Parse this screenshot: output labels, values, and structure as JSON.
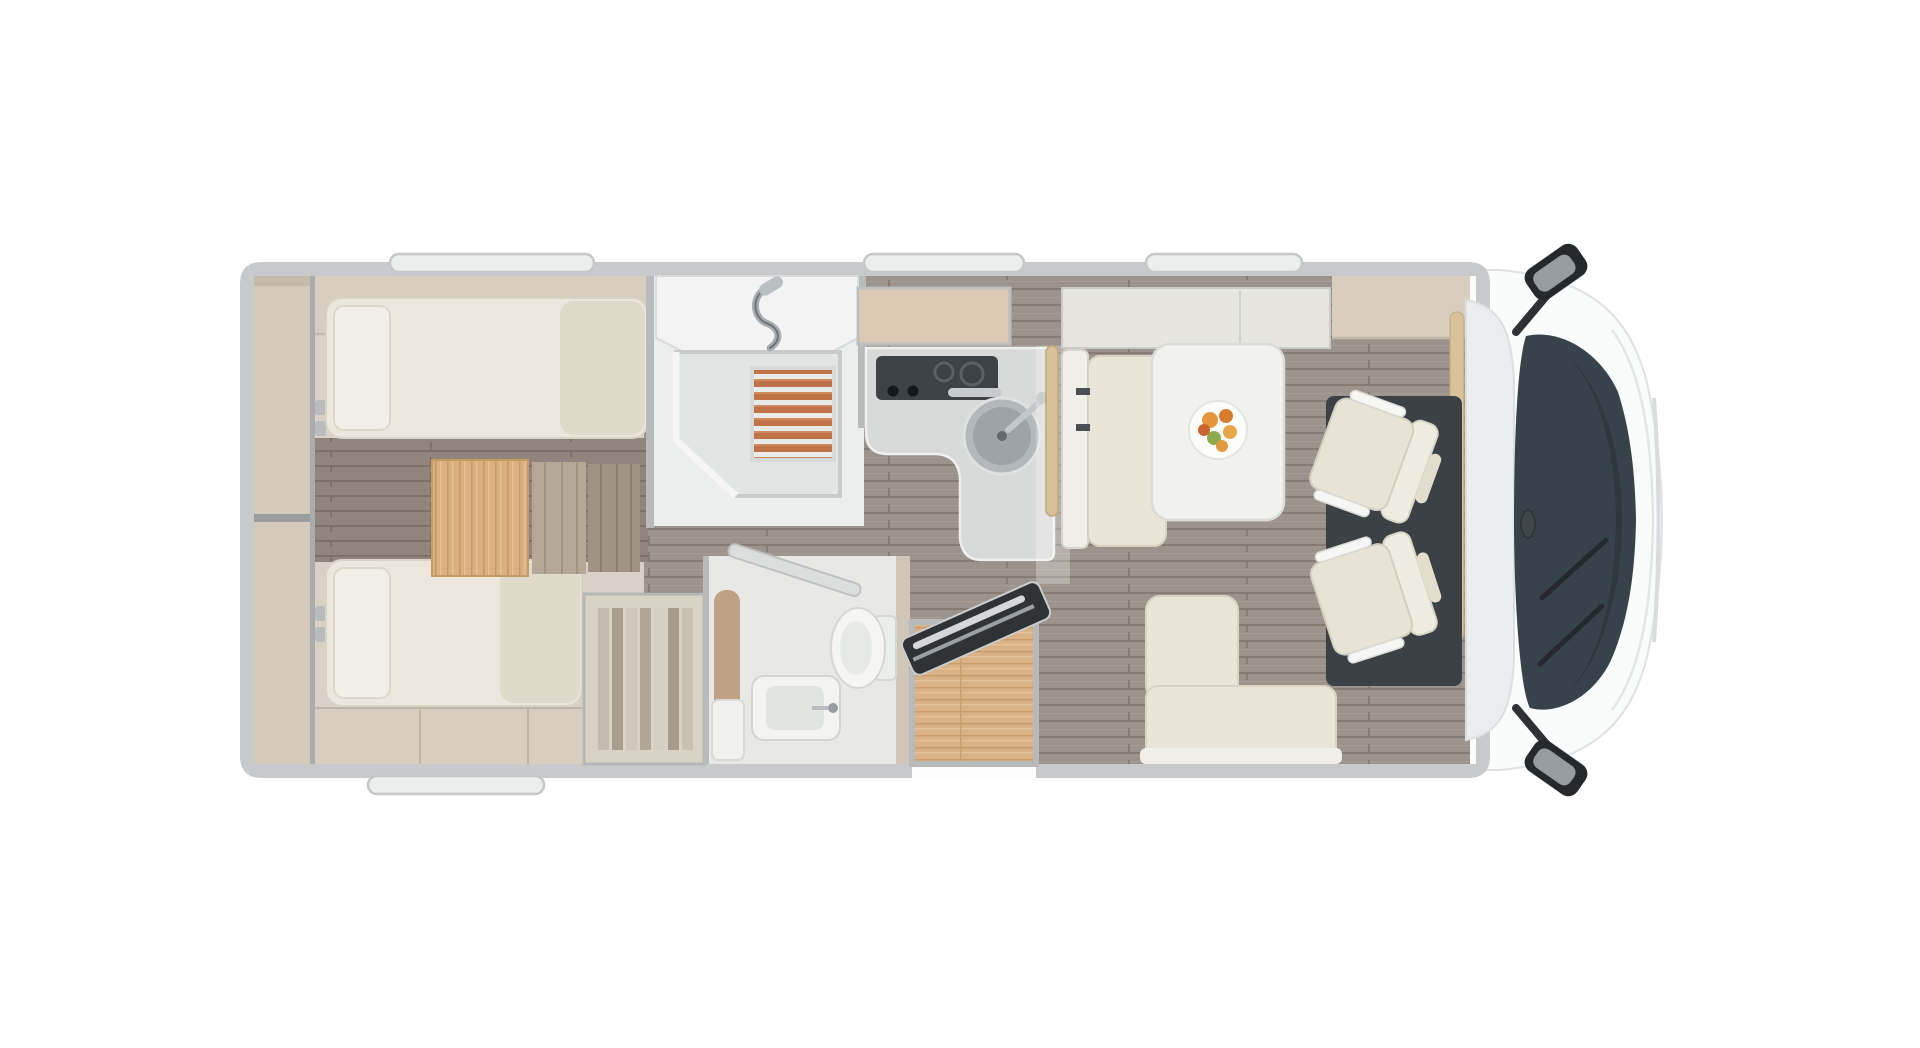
{
  "meta": {
    "title": "Motorhome floor plan - top view",
    "type": "vehicle-floor-plan",
    "orientation": "rear-left-front-right"
  },
  "rooms": {
    "rear_storage": "rear-garage-storage",
    "bedroom": "twin-single-beds-bedroom",
    "shower": "shower-cubicle",
    "washroom": "toilet-and-washbasin",
    "kitchen": "l-shaped-kitchen",
    "dinette": "dinette-with-table",
    "entrance": "entrance-with-step",
    "cab": "driver-cab"
  },
  "furniture": [
    "twin-bed-upper",
    "twin-bed-lower",
    "pillow-upper",
    "pillow-lower",
    "bedside-steps",
    "oak-dresser",
    "wardrobe-hanging-clothes",
    "shower-tray",
    "teak-grating",
    "shower-mixer",
    "toilet",
    "washbasin",
    "kitchen-hob",
    "kitchen-sink",
    "kitchen-window",
    "sideboard",
    "travel-bench",
    "dining-table",
    "fruit-plate",
    "lounge-bench-l",
    "entrance-step",
    "entry-door-open",
    "washroom-door-open",
    "swivel-cab-seat-upper",
    "swivel-cab-seat-lower",
    "windshield",
    "wing-mirror-top",
    "wing-mirror-bottom"
  ],
  "colors": {
    "background": "#ffffff",
    "body_wall": "#c7c9cb",
    "body_white": "#fafbfb",
    "interior_wall": "#d9d1c5",
    "overhead_locker": "#d7cec0",
    "storage_shelf": "#d3cabc",
    "mattress": "#ebe7dc",
    "pillow": "#f2efe8",
    "oak_wood": "#d9b285",
    "step_wood": "#b5a897",
    "floor_plank": "#9c938c",
    "teak_slat": "#bf7347",
    "shower_tray": "#e3e5e5",
    "counter": "#d8dad9",
    "hob": "#3c4246",
    "sink": "#9da4a8",
    "window_tan": "#d9cab1",
    "bench_cushion": "#e9e5d7",
    "table_top": "#f1f2ed",
    "grab_rail": "#d9c298",
    "cab_floor": "#3b4145",
    "cab_seat": "#e7e3d5",
    "windshield": "#37434a",
    "mirror_glass": "#959da2",
    "door_dark": "#2f3335",
    "toilet_white": "#f5f6f4",
    "wardrobe": "#d9d3c6",
    "window_frame": "#eceded"
  }
}
